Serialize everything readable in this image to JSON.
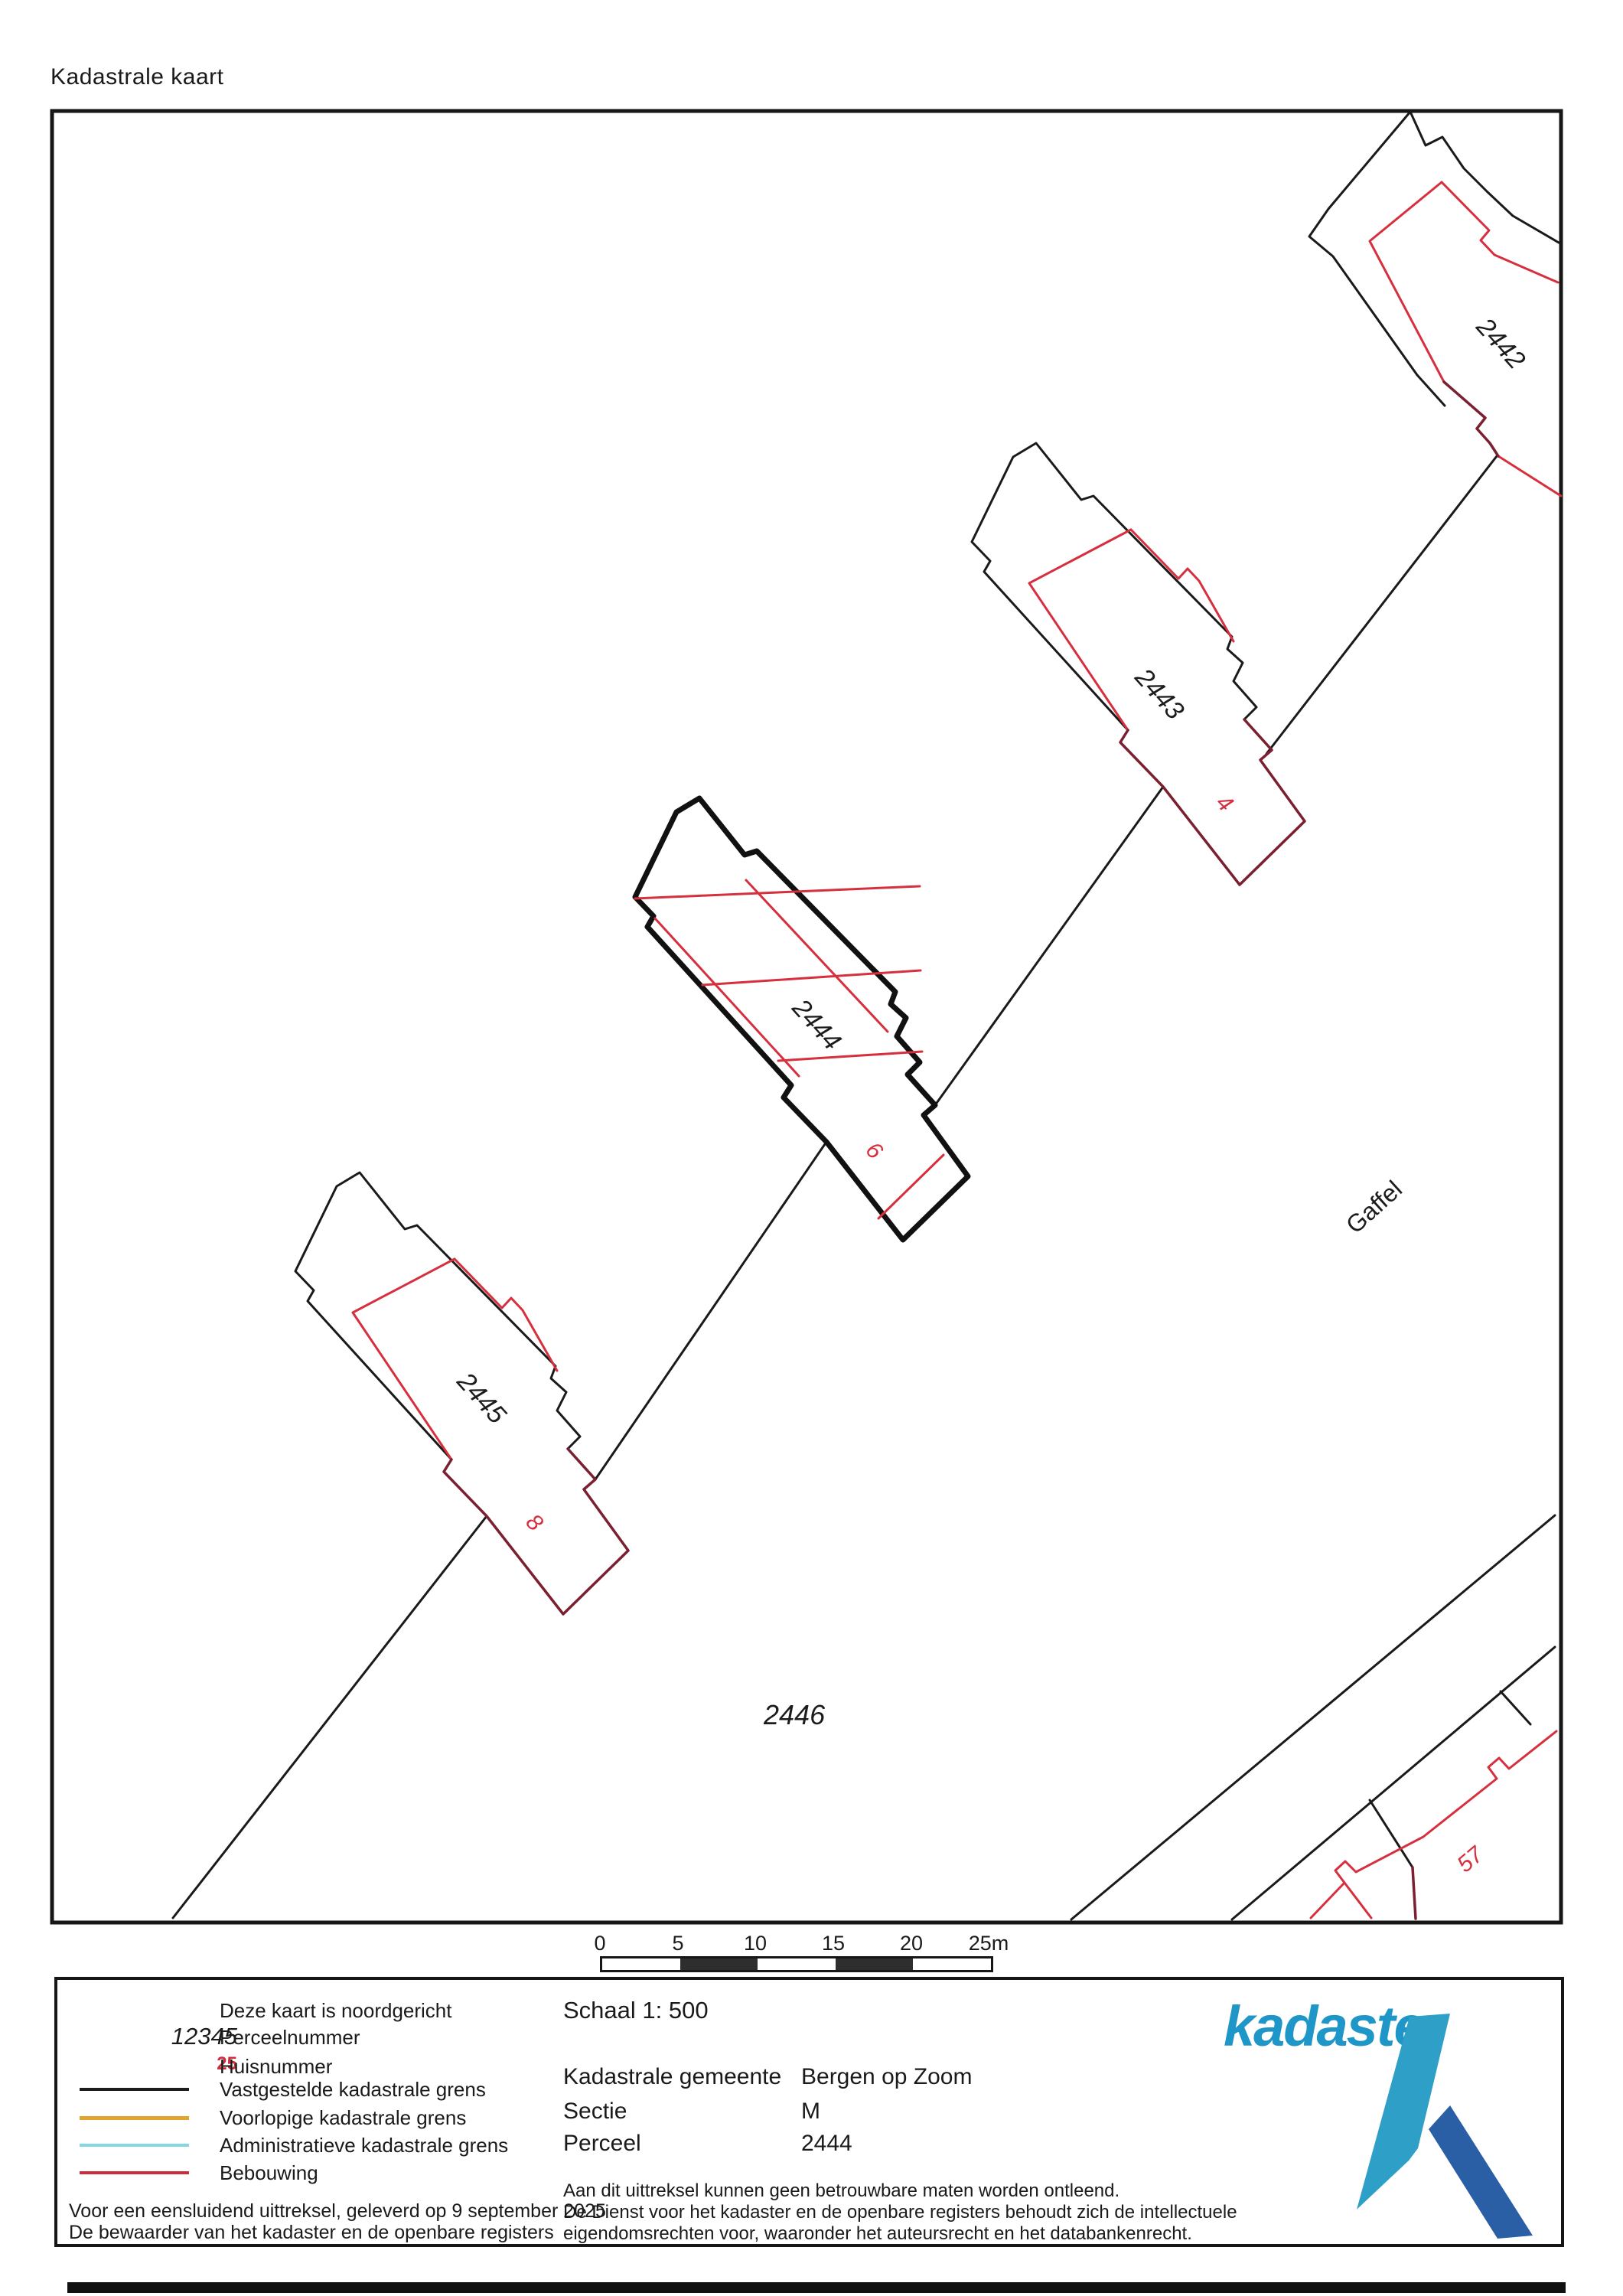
{
  "title": "Kadastrale kaart",
  "map": {
    "parcels": {
      "p2442": "2442",
      "p2443": "2443",
      "p2444": "2444",
      "p2445": "2445",
      "p2446": "2446"
    },
    "house_numbers": {
      "h4": "4",
      "h6": "6",
      "h8": "8",
      "h57": "57"
    },
    "street": "Gaffel"
  },
  "scale_bar": {
    "ticks": [
      "0",
      "5",
      "10",
      "15",
      "20",
      "25m"
    ]
  },
  "legend": {
    "north_note": "Deze kaart is noordgericht",
    "sample_parcel": "12345",
    "sample_house": "25",
    "items": {
      "perceel": "Perceelnummer",
      "huis": "Huisnummer",
      "vast": "Vastgestelde kadastrale grens",
      "voor": "Voorlopige kadastrale grens",
      "admin": "Administratieve kadastrale grens",
      "bebouwing": "Bebouwing"
    },
    "footer1": "Voor een eensluidend uittreksel, geleverd op 9 september 2025",
    "footer2": "De bewaarder van het kadaster en de openbare registers"
  },
  "details": {
    "scale_label": "Schaal 1: 500",
    "rows": [
      {
        "label": "Kadastrale gemeente",
        "value": "Bergen op Zoom"
      },
      {
        "label": "Sectie",
        "value": "M"
      },
      {
        "label": "Perceel",
        "value": "2444"
      }
    ],
    "disclaimer_lines": [
      "Aan dit uittreksel kunnen geen betrouwbare maten worden ontleend.",
      "De Dienst voor het kadaster en de openbare registers behoudt zich de intellectuele",
      "eigendomsrechten voor, waaronder het auteursrecht en het databankenrecht."
    ]
  },
  "logo": {
    "wordmark": "kadaster"
  },
  "colors": {
    "boundary": "#1a1a1a",
    "building": "#d6303f",
    "building_dark": "#7a2030",
    "legend_yellow": "#e1a42c",
    "legend_cyan": "#82d7e6",
    "legend_red": "#cd2c3c",
    "logo_blue": "#1e96c8",
    "logo_light": "#2e9fc6",
    "logo_dark": "#2a5fa5"
  }
}
